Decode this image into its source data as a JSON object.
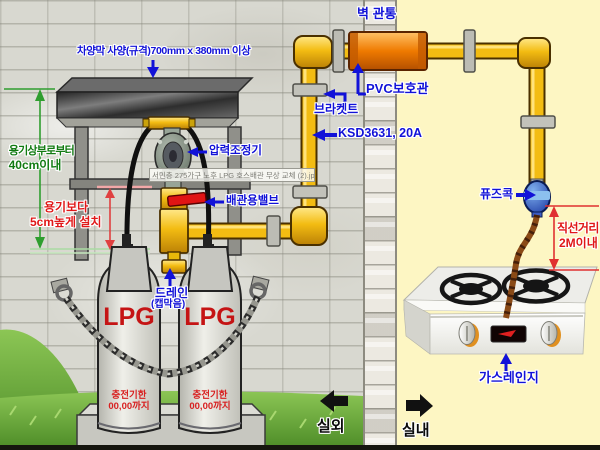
{
  "labels": {
    "canopy_spec": "차양막 사양(규격)700mm x 380mm 이상",
    "wall_penetration": "벽 관통",
    "pvc_protection": "PVC보호관",
    "bracket": "브라켓트",
    "pipe_standard": "KSD3631, 20A",
    "regulator": "압력조정기",
    "pipe_valve": "배관용밸브",
    "drain": "드레인",
    "drain_cap": "(캡막음)",
    "fuse_cock": "퓨즈콕",
    "gas_range": "가스레인지",
    "outdoor": "실외",
    "indoor": "실내"
  },
  "dimensions": {
    "from_top_line1": "용기상부로부터",
    "from_top_line2": "40cm이내",
    "height_line1": "용기보다",
    "height_line2": "5cm높게 설치",
    "straight_line1": "직선거리",
    "straight_line2": "2M이내"
  },
  "cylinders": {
    "gas": "LPG",
    "expiry_line1": "충전기한",
    "expiry_line2": "00,00까지"
  },
  "watermark": "서민층 275가구 노후 LPG 호스배관 무상 교체 (2).jpg",
  "colors": {
    "label_blue": "#1212D8",
    "pipe_yellow": "#F3BC12",
    "sleeve_orange": "#EF7A00",
    "dim_green": "#2F9E2F",
    "dim_red": "#E03030",
    "lpg_red": "#C51414",
    "fuse_blue": "#1A3CB0",
    "hose_brown": "#8A4A16",
    "indoor_bg": "#FDF6C3",
    "wall_gray": "#D8D8D0",
    "grass_green": "#5E9E32"
  }
}
